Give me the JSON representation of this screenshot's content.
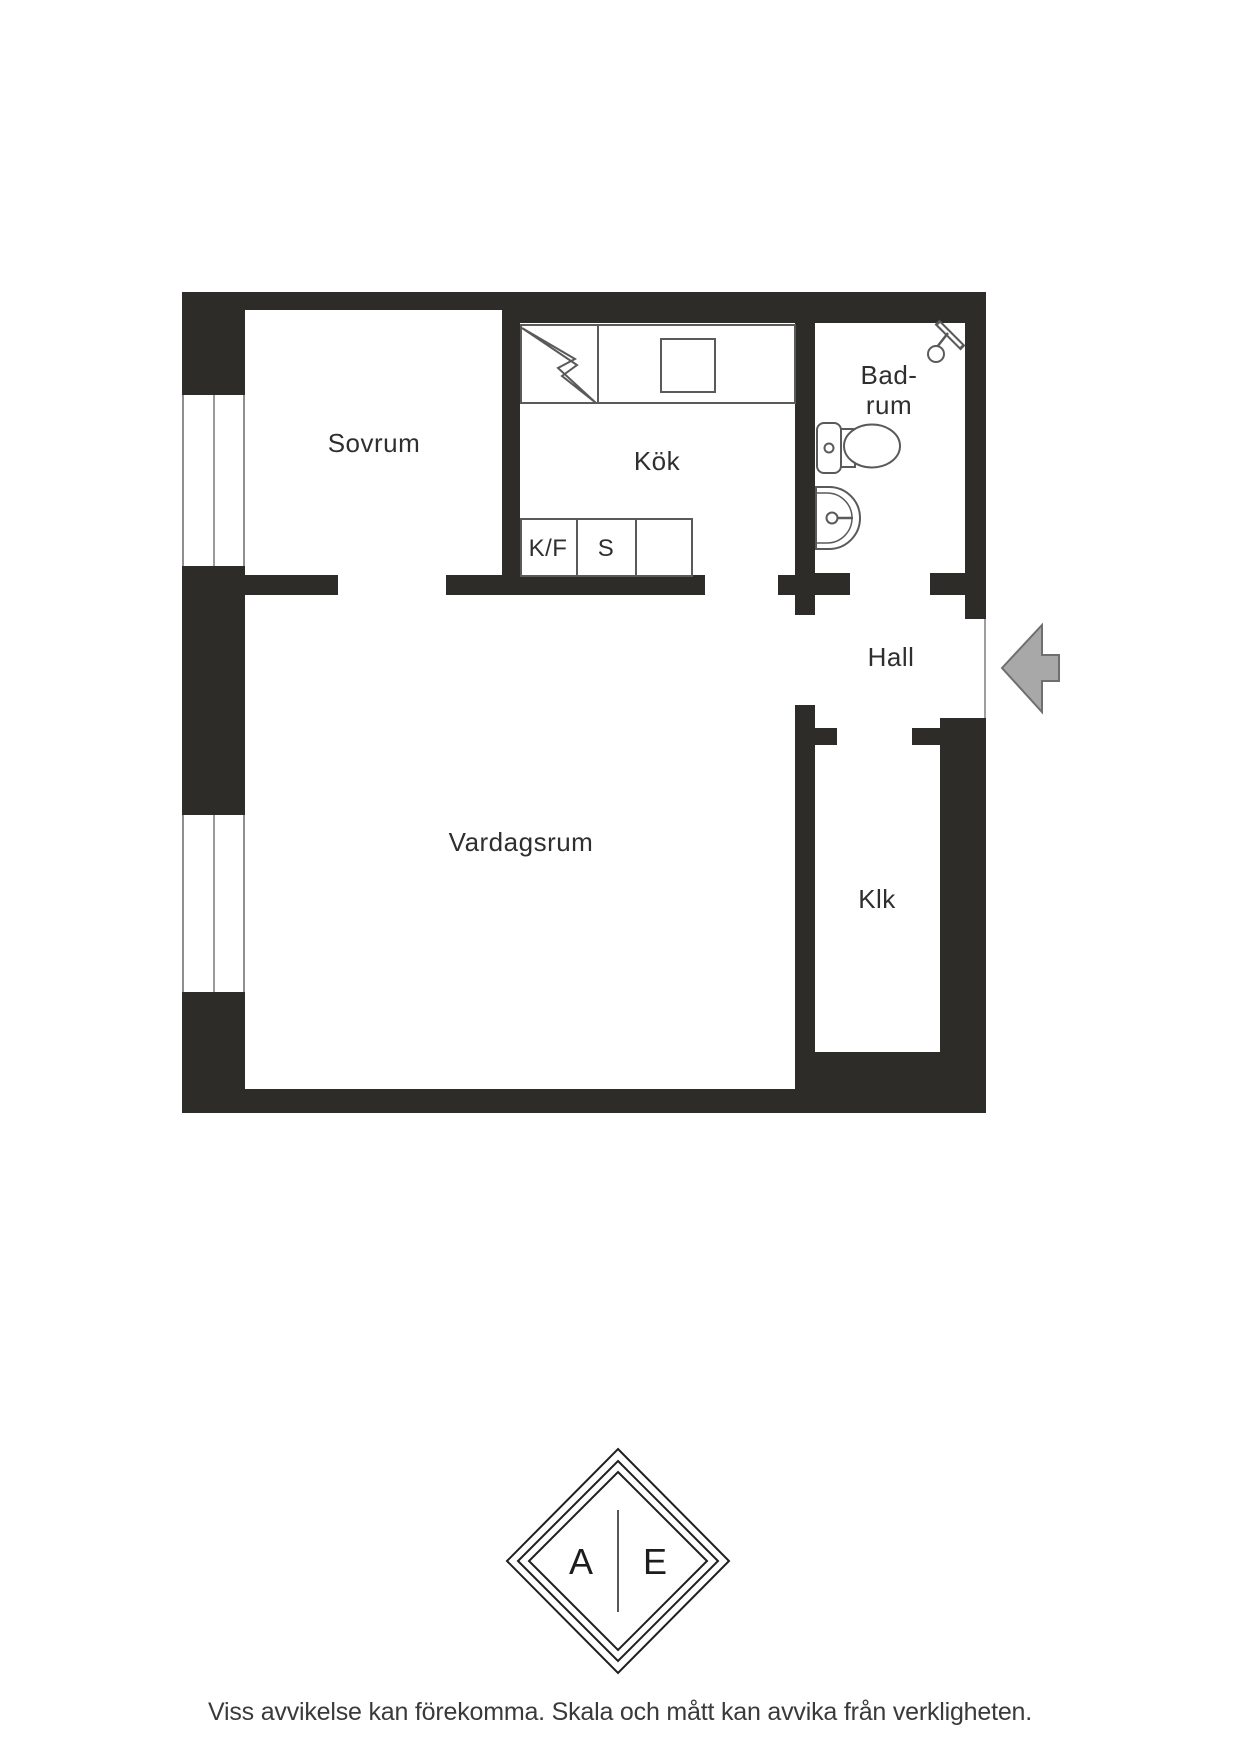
{
  "floorplan": {
    "rooms": {
      "sovrum": {
        "label": "Sovrum"
      },
      "kok": {
        "label": "Kök"
      },
      "badrum": {
        "line1": "Bad-",
        "line2": "rum"
      },
      "hall": {
        "label": "Hall"
      },
      "vardagsrum": {
        "label": "Vardagsrum"
      },
      "klk": {
        "label": "Klk"
      }
    },
    "kitchen": {
      "fridge_freezer_label": "K/F",
      "stove_label": "S"
    },
    "icons": {
      "shower": "shower-icon",
      "toilet": "toilet-icon",
      "sink": "sink-icon",
      "stove_power": "lightning-icon",
      "entrance": "entrance-arrow-icon"
    },
    "colors": {
      "wall": "#2d2c28",
      "fixture_line": "#5a5a5a",
      "window_line": "#8f8f8f",
      "label_text": "#2f2f2f",
      "arrow_fill": "#a8a8a8",
      "arrow_stroke": "#6f6f6f"
    }
  },
  "logo": {
    "left_letter": "A",
    "right_letter": "E"
  },
  "footer": {
    "disclaimer": "Viss avvikelse kan förekomma. Skala och mått kan avvika från verkligheten."
  }
}
